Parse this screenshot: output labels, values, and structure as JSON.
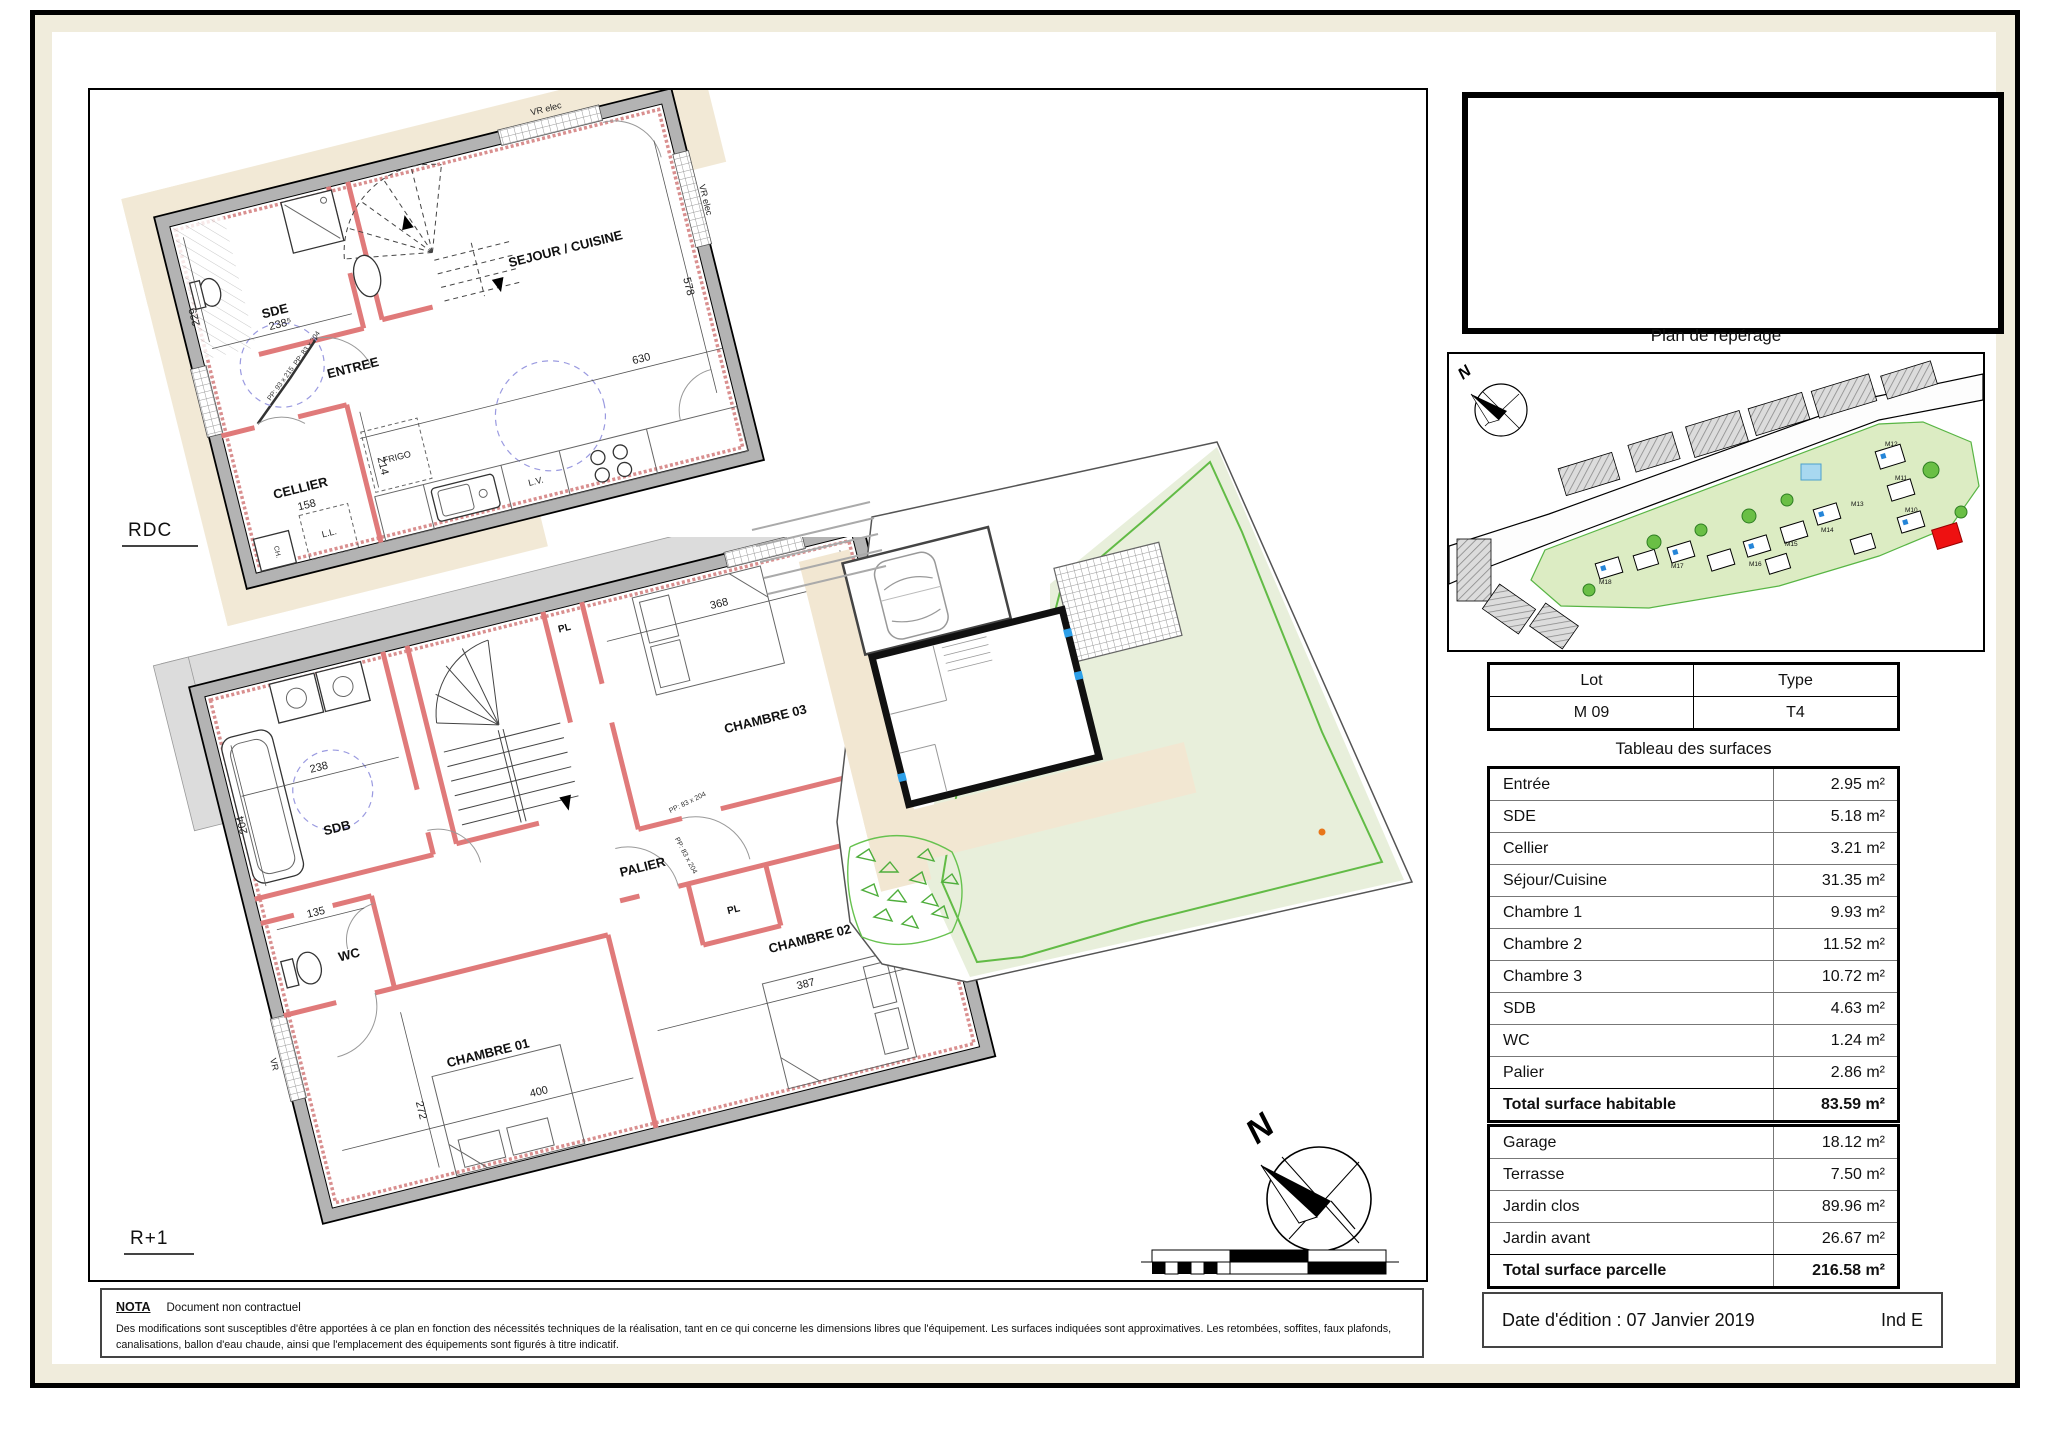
{
  "plan_area": {
    "compass_n": "N",
    "scale_ticks": [
      "0",
      "1",
      "2",
      "3"
    ]
  },
  "rdc": {
    "floor_label": "RDC",
    "rooms": {
      "sde": "SDE",
      "entree": "ENTREE",
      "cellier": "CELLIER",
      "sejour": "SEJOUR / CUISINE"
    },
    "dims": {
      "d238": "238⁵",
      "d229": "229",
      "d630": "630",
      "d578": "578",
      "d158": "158",
      "d214": "214"
    },
    "labels": {
      "frigo": "FRIGO",
      "lv": "L.V.",
      "ll": "L.L.",
      "ch": "CH.",
      "vr1": "VR elec",
      "vr2": "VR elec",
      "pp1": "PP: 93 x 215",
      "pp2": "PP: 83 x 204"
    }
  },
  "r1": {
    "floor_label": "R+1",
    "rooms": {
      "sdb": "SDB",
      "wc": "WC",
      "palier": "PALIER",
      "ch1": "CHAMBRE 01",
      "ch2": "CHAMBRE 02",
      "ch3": "CHAMBRE 03"
    },
    "dims": {
      "d238": "238",
      "d204": "204",
      "d135": "135",
      "d368": "368",
      "d294": "294",
      "d387": "387",
      "d278": "278",
      "d272": "272",
      "d400": "400"
    },
    "labels": {
      "pl1": "PL",
      "pl2": "PL",
      "vr1": "VR",
      "vr2": "VR",
      "vr3": "VR",
      "pp1": "PP: 83 x 204",
      "pp2": "PP: 83 x 204"
    }
  },
  "nota": {
    "title": "NOTA",
    "subtitle": "Document non contractuel",
    "body": "Des modifications sont susceptibles d'être apportées à ce plan en fonction des nécessités techniques de la réalisation, tant en ce qui concerne les dimensions libres que l'équipement. Les surfaces indiquées sont approximatives. Les retombées, soffites, faux plafonds, canalisations, ballon d'eau chaude, ainsi que l'emplacement des équipements sont figurés à titre indicatif."
  },
  "right": {
    "reperage_title": "Plan de repérage",
    "map_compass_n": "N",
    "map_lots": [
      "M18",
      "M17",
      "M16",
      "M15",
      "M14",
      "M13",
      "M12",
      "M11",
      "M10"
    ],
    "lot_headers": [
      "Lot",
      "Type"
    ],
    "lot_values": [
      "M 09",
      "T4"
    ],
    "surfaces_title": "Tableau des surfaces",
    "surfaces_rows": [
      {
        "label": "Entrée",
        "value": "2.95 m²"
      },
      {
        "label": "SDE",
        "value": "5.18 m²"
      },
      {
        "label": "Cellier",
        "value": "3.21 m²"
      },
      {
        "label": "Séjour/Cuisine",
        "value": "31.35 m²"
      },
      {
        "label": "Chambre 1",
        "value": "9.93 m²"
      },
      {
        "label": "Chambre 2",
        "value": "11.52 m²"
      },
      {
        "label": "Chambre 3",
        "value": "10.72 m²"
      },
      {
        "label": "SDB",
        "value": "4.63 m²"
      },
      {
        "label": "WC",
        "value": "1.24 m²"
      },
      {
        "label": "Palier",
        "value": "2.86 m²"
      }
    ],
    "surfaces_total": {
      "label": "Total surface habitable",
      "value": "83.59 m²"
    },
    "annex_rows": [
      {
        "label": "Garage",
        "value": "18.12 m²"
      },
      {
        "label": "Terrasse",
        "value": "7.50 m²"
      },
      {
        "label": "Jardin clos",
        "value": "89.96 m²"
      },
      {
        "label": "Jardin avant",
        "value": "26.67 m²"
      }
    ],
    "annex_total": {
      "label": "Total surface parcelle",
      "value": "216.58 m²"
    },
    "edition_date": "Date d'édition : 07 Janvier 2019",
    "edition_ind": "Ind E"
  }
}
